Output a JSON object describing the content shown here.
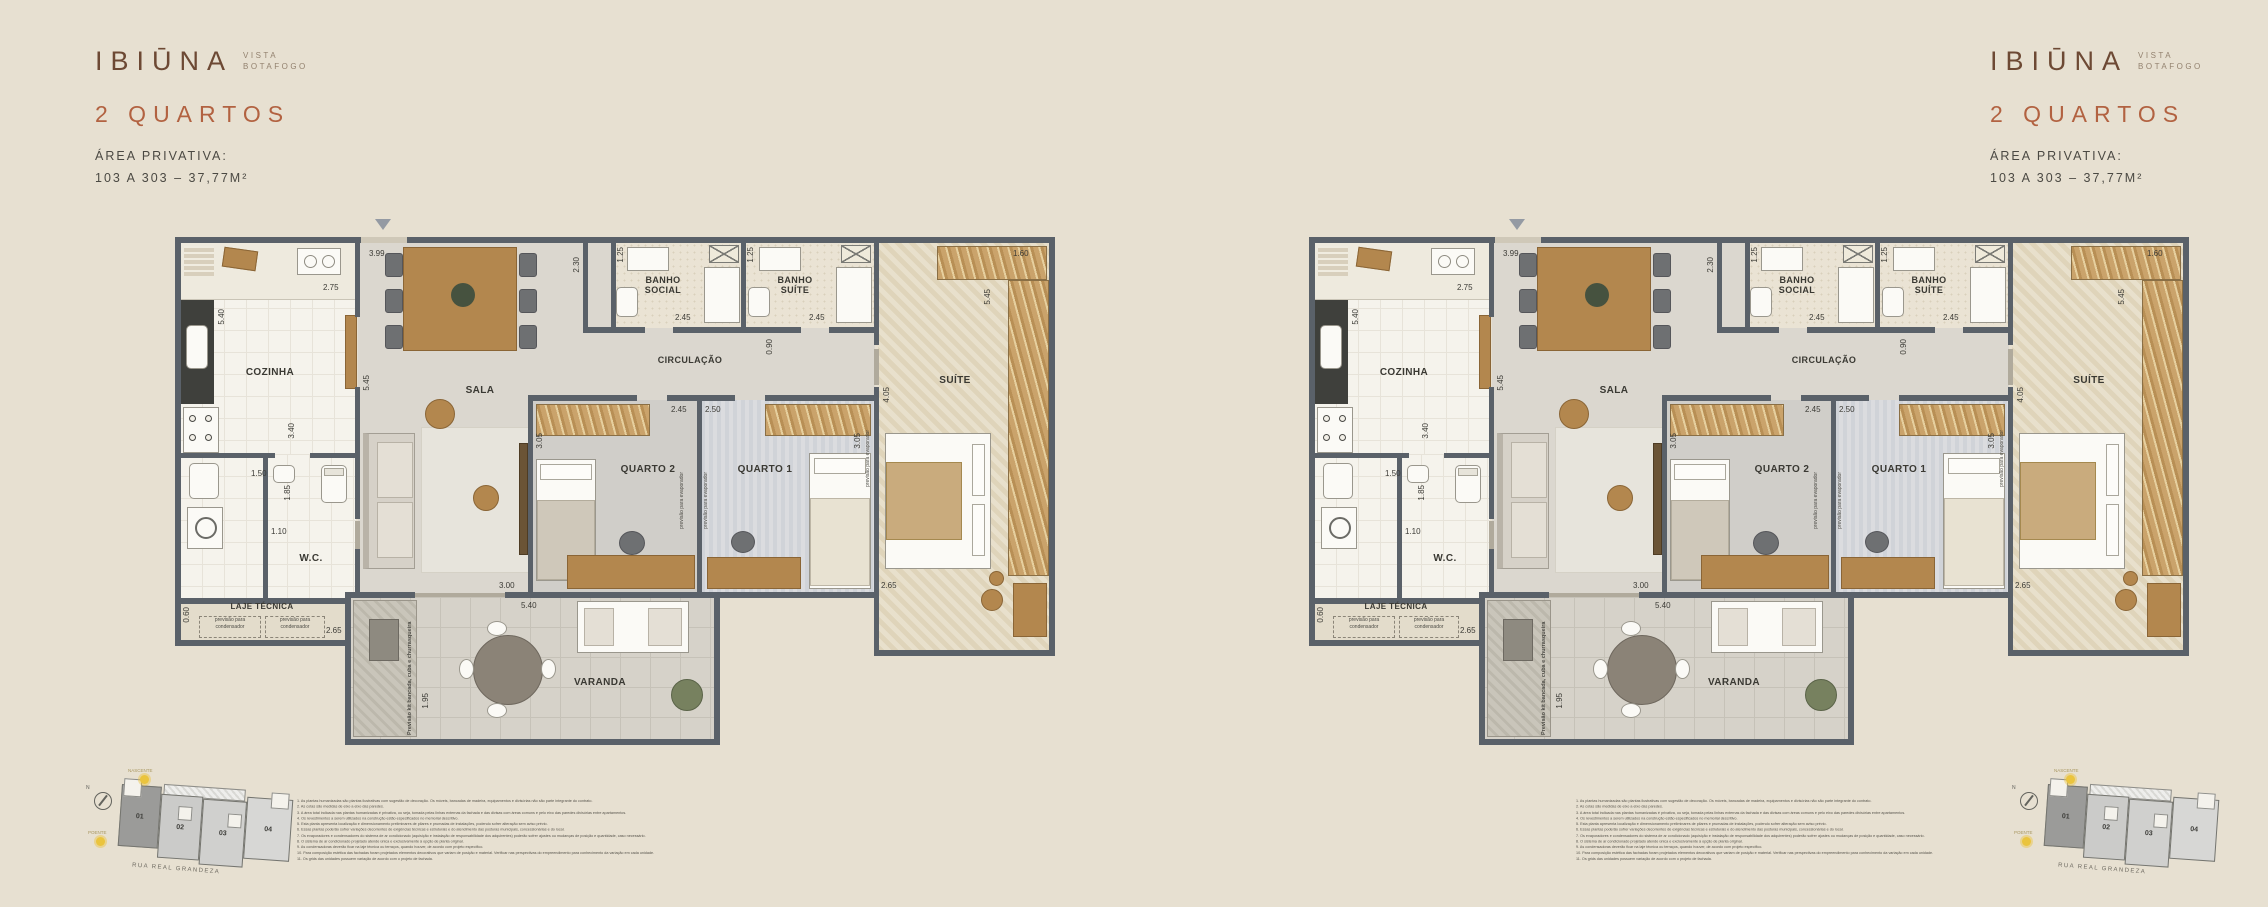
{
  "colors": {
    "background": "#e7e0d1",
    "accent": "#b26241",
    "logo": "#6d4934",
    "wall": "#5a6169",
    "sun": "#eac43e"
  },
  "brand": {
    "name": "IBIŪNA",
    "sub1": "VISTA",
    "sub2": "BOTAFOGO"
  },
  "header": {
    "title": "2 QUARTOS",
    "area_label": "ÁREA PRIVATIVA:",
    "area_value": "103 A 303 – 37,77M²"
  },
  "plan": {
    "rooms": {
      "cozinha": "COZINHA",
      "sala": "SALA",
      "banho_social": "BANHO SOCIAL",
      "banho_suite": "BANHO SUÍTE",
      "circulacao": "CIRCULAÇÃO",
      "suite": "SUÍTE",
      "quarto2": "QUARTO 2",
      "quarto1": "QUARTO 1",
      "wc": "W.C.",
      "laje": "LAJE TÉCNICA",
      "varanda": "VARANDA"
    },
    "notes": {
      "condensador": "previsão para condensador",
      "evaporador": "previsão para evaporador",
      "kit": "Previsão kit bancada, cuba e churrasqueira"
    },
    "dims": {
      "sala_top": "3.99",
      "coz_top": "2.75",
      "coz_left": "5.40",
      "coz_right": "3.40",
      "coz_bottom": "1.50",
      "coz_door": "1.85",
      "wc": "1.10",
      "laje_h": "0.60",
      "laje_w": "2.65",
      "sala_left": "5.45",
      "sala_bottom": "3.00",
      "hall": "2.30",
      "bs_w": "1.25",
      "bs_b": "2.45",
      "bst_w": "1.25",
      "bst_b": "2.45",
      "circ": "0.90",
      "closet_top": "1.60",
      "closet_side": "5.45",
      "suite_h": "4.05",
      "suite_b": "2.65",
      "q2_top": "2.45",
      "q1_top": "2.50",
      "q2_side": "3.05",
      "q1_side": "3.05",
      "var_w": "5.40",
      "var_h": "1.95"
    }
  },
  "keymap": {
    "units": [
      "01",
      "02",
      "03",
      "04"
    ],
    "street": "RUA REAL GRANDEZA",
    "sun_top": "NASCENTE",
    "sun_left": "POENTE",
    "compass_n": "N"
  },
  "disclaimer": [
    "1. As plantas humanizadas são plantas ilustrativas com sugestão de decoração. Os móveis, bancadas de madeira, equipamentos e divisórias não são parte integrante do contrato.",
    "2. As cotas são medidas de eixo a eixo das paredes.",
    "3. A área total indicada nas plantas humanizadas é privativa, ou seja, tomada pelas linhas externas da fachada e das divisas com áreas comuns e pelo eixo das paredes divisórias entre apartamentos.",
    "4. Os revestimentos a serem utilizados na construção estão especificados no memorial descritivo.",
    "5. Esta planta apresenta localização e dimensionamento preliminares de pilares e prumadas de instalações, podendo sofrer alteração sem aviso prévio.",
    "6. Essas plantas poderão sofrer variações decorrentes de exigências técnicas e estruturais e do atendimento das posturas municipais, concessionárias e do local.",
    "7. Os evaporadores e condensadores do sistema de ar condicionado (aquisição e instalação de responsabilidade dos adquirentes) poderão sofrer ajustes ou mudanças de posição e quantidade, caso necessário.",
    "8. O sistema de ar condicionado projetado atende única e exclusivamente à opção de planta original.",
    "9. As condensadoras deverão ficar na laje técnica ou terraços, quando houver, de acordo com projeto específico.",
    "10. Para composição estética das fachadas foram projetados elementos decorativos que variam de posição e material. Verificar nas perspectivas do empreendimento para conhecimento da variação em cada unidade.",
    "11. Os grids das unidades possuem variação de acordo com o projeto de fachada."
  ]
}
